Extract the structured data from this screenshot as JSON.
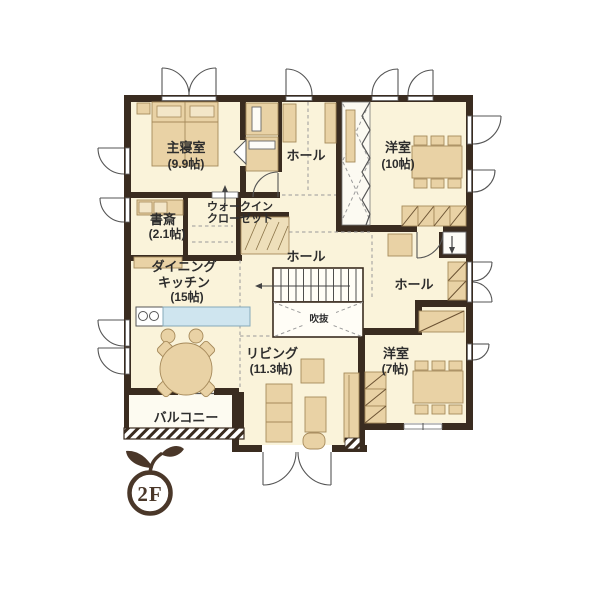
{
  "floor_plan": {
    "floor_label": "2F",
    "rooms": {
      "master_bedroom": {
        "name": "主寝室",
        "size": "(9.9帖)"
      },
      "hall_top": {
        "name": "ホール"
      },
      "western_room_10": {
        "name": "洋室",
        "size": "(10帖)"
      },
      "study": {
        "name": "書斎",
        "size": "(2.1帖)"
      },
      "walk_in_closet": {
        "line1": "ウォークイン",
        "line2": "クローゼット"
      },
      "hall_center": {
        "name": "ホール"
      },
      "hall_right": {
        "name": "ホール"
      },
      "void": {
        "name": "吹抜"
      },
      "dining_kitchen": {
        "line1": "ダイニング",
        "line2": "キッチン",
        "size": "(15帖)"
      },
      "living": {
        "name": "リビング",
        "size": "(11.3帖)"
      },
      "western_room_7": {
        "name": "洋室",
        "size": "(7帖)"
      },
      "balcony": {
        "name": "バルコニー"
      }
    },
    "colors": {
      "wall": "#3a2c20",
      "floor": "#faf3da",
      "furniture": "#e9d2a5",
      "kitchen_counter": "#cfe5ef",
      "logo": "#4a3729",
      "text": "#2d2d2d"
    }
  }
}
